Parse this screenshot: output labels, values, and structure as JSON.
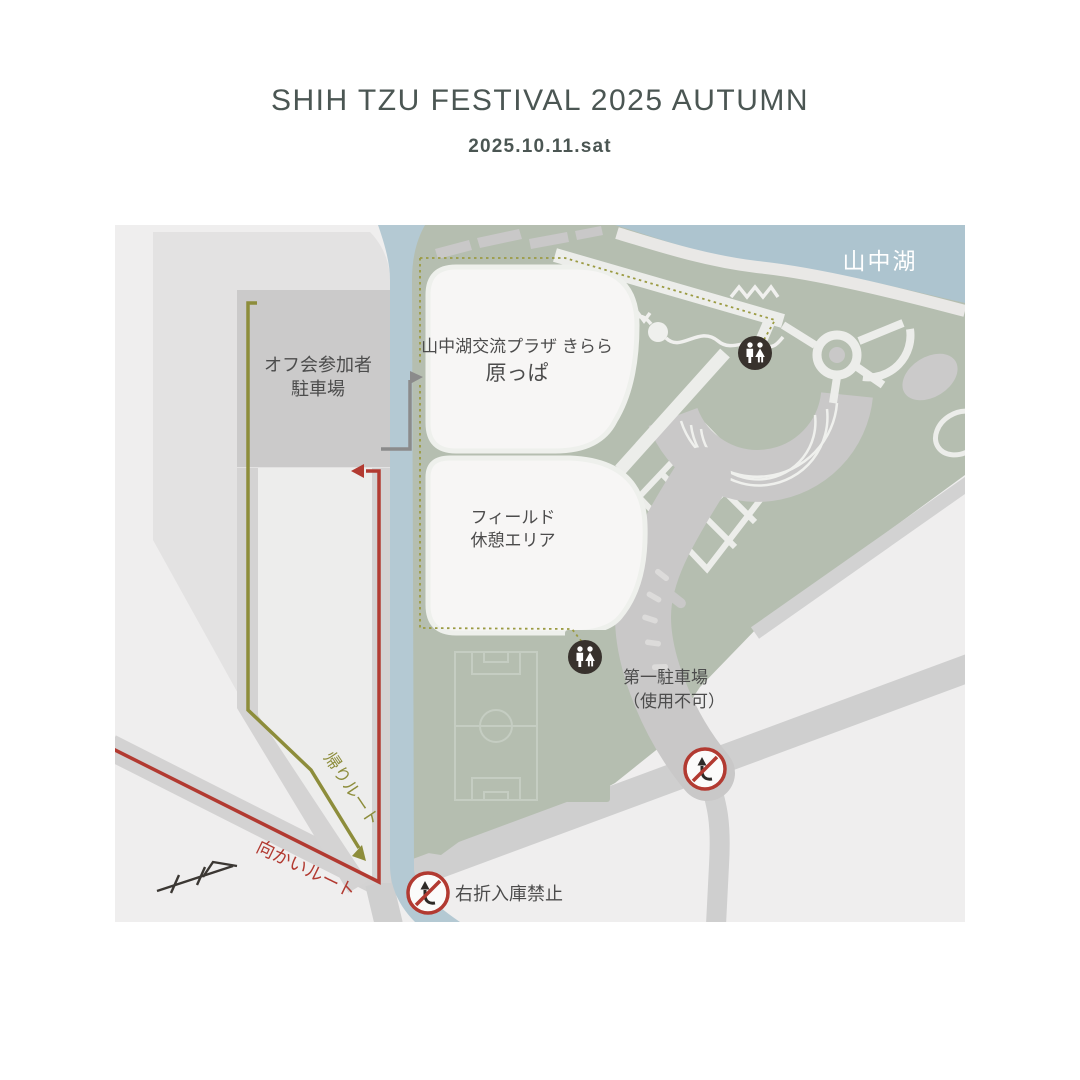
{
  "title": "SHIH TZU FESTIVAL 2025 AUTUMN",
  "subtitle": "2025.10.11.sat",
  "map": {
    "lake": "山中湖",
    "offkai_parking": {
      "line1": "オフ会参加者",
      "line2": "駐車場"
    },
    "plaza": {
      "line1": "山中湖交流プラザ きらら",
      "line2": "原っぱ"
    },
    "field": {
      "line1": "フィールド",
      "line2": "休憩エリア"
    },
    "parking1": {
      "line1": "第一駐車場",
      "line2": "（使用不可）"
    },
    "no_right_turn": "右折入庫禁止",
    "routes": {
      "return": "帰りルート",
      "outbound": "向かいルート"
    }
  },
  "icons": [
    "restroom-icon",
    "no-right-turn-icon",
    "railway-crossing-icon",
    "entrance-arrow",
    "outbound-route-arrow",
    "return-route-arrow"
  ],
  "colors": {
    "title_text": "#4b5653",
    "map_background": "#efeeee",
    "park_green": "#b5beb0",
    "lake_blue": "#adc4cf",
    "river_blue": "#b4c9d3",
    "route_outbound_red": "#b23a31",
    "route_return_olive": "#8d8d3b",
    "dotted_walk_route": "#9b9b42",
    "prohibition_red": "#b23a31",
    "icon_dark": "#38322d",
    "label_text": "#4c4c4c"
  }
}
